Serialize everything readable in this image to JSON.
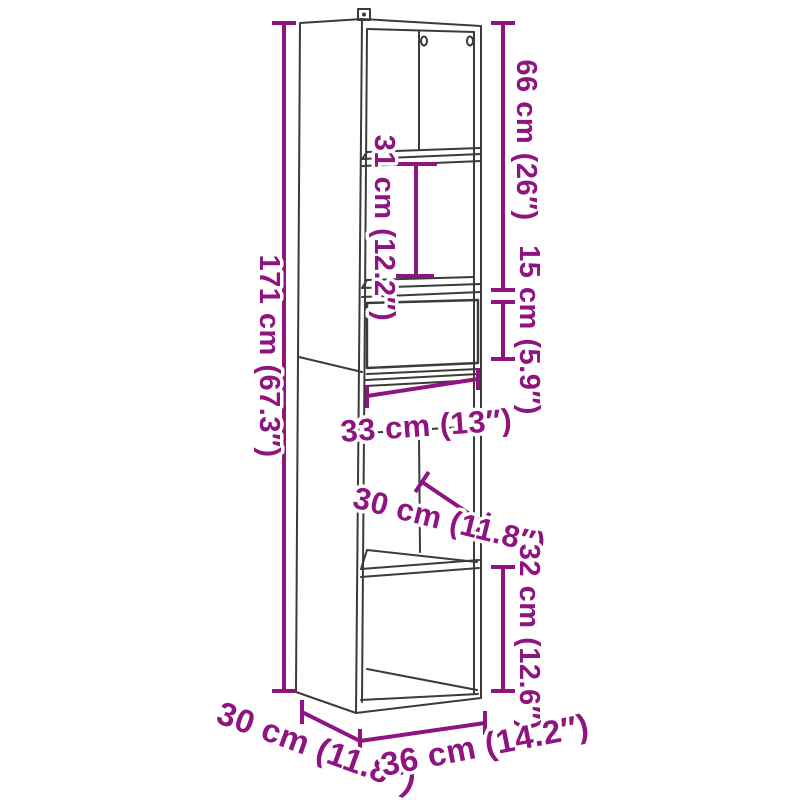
{
  "diagram": {
    "description": "Line drawing of a tall narrow bookcase / highboard with one drawer, shown in perspective with dimension annotations",
    "colors": {
      "dimension_annotation": "#8e1480",
      "drawing_outline": "#3b3b3a",
      "background": "#ffffff"
    },
    "dimensions": [
      {
        "id": "total-height",
        "label": "171 cm (67.3″)",
        "cm": 171,
        "inches": 67.3,
        "orientation": "vertical-left"
      },
      {
        "id": "top-section-height",
        "label": "66 cm (26″)",
        "cm": 66,
        "inches": 26,
        "orientation": "vertical-right"
      },
      {
        "id": "shelf-spacing",
        "label": "31 cm (12.2″)",
        "cm": 31,
        "inches": 12.2,
        "orientation": "vertical-inside"
      },
      {
        "id": "drawer-height",
        "label": "15 cm (5.9″)",
        "cm": 15,
        "inches": 5.9,
        "orientation": "vertical-right"
      },
      {
        "id": "inner-width",
        "label": "33 cm (13″)",
        "cm": 33,
        "inches": 13,
        "orientation": "horizontal-inside"
      },
      {
        "id": "inner-depth",
        "label": "30 cm (11.8″)",
        "cm": 30,
        "inches": 11.8,
        "orientation": "diagonal-inside"
      },
      {
        "id": "bottom-compartment-height",
        "label": "32 cm (12.6″)",
        "cm": 32,
        "inches": 12.6,
        "orientation": "vertical-right"
      },
      {
        "id": "depth",
        "label": "30 cm (11.8″)",
        "cm": 30,
        "inches": 11.8,
        "orientation": "diagonal-bottom-left"
      },
      {
        "id": "width",
        "label": "36 cm (14.2″)",
        "cm": 36,
        "inches": 14.2,
        "orientation": "bottom"
      }
    ]
  }
}
